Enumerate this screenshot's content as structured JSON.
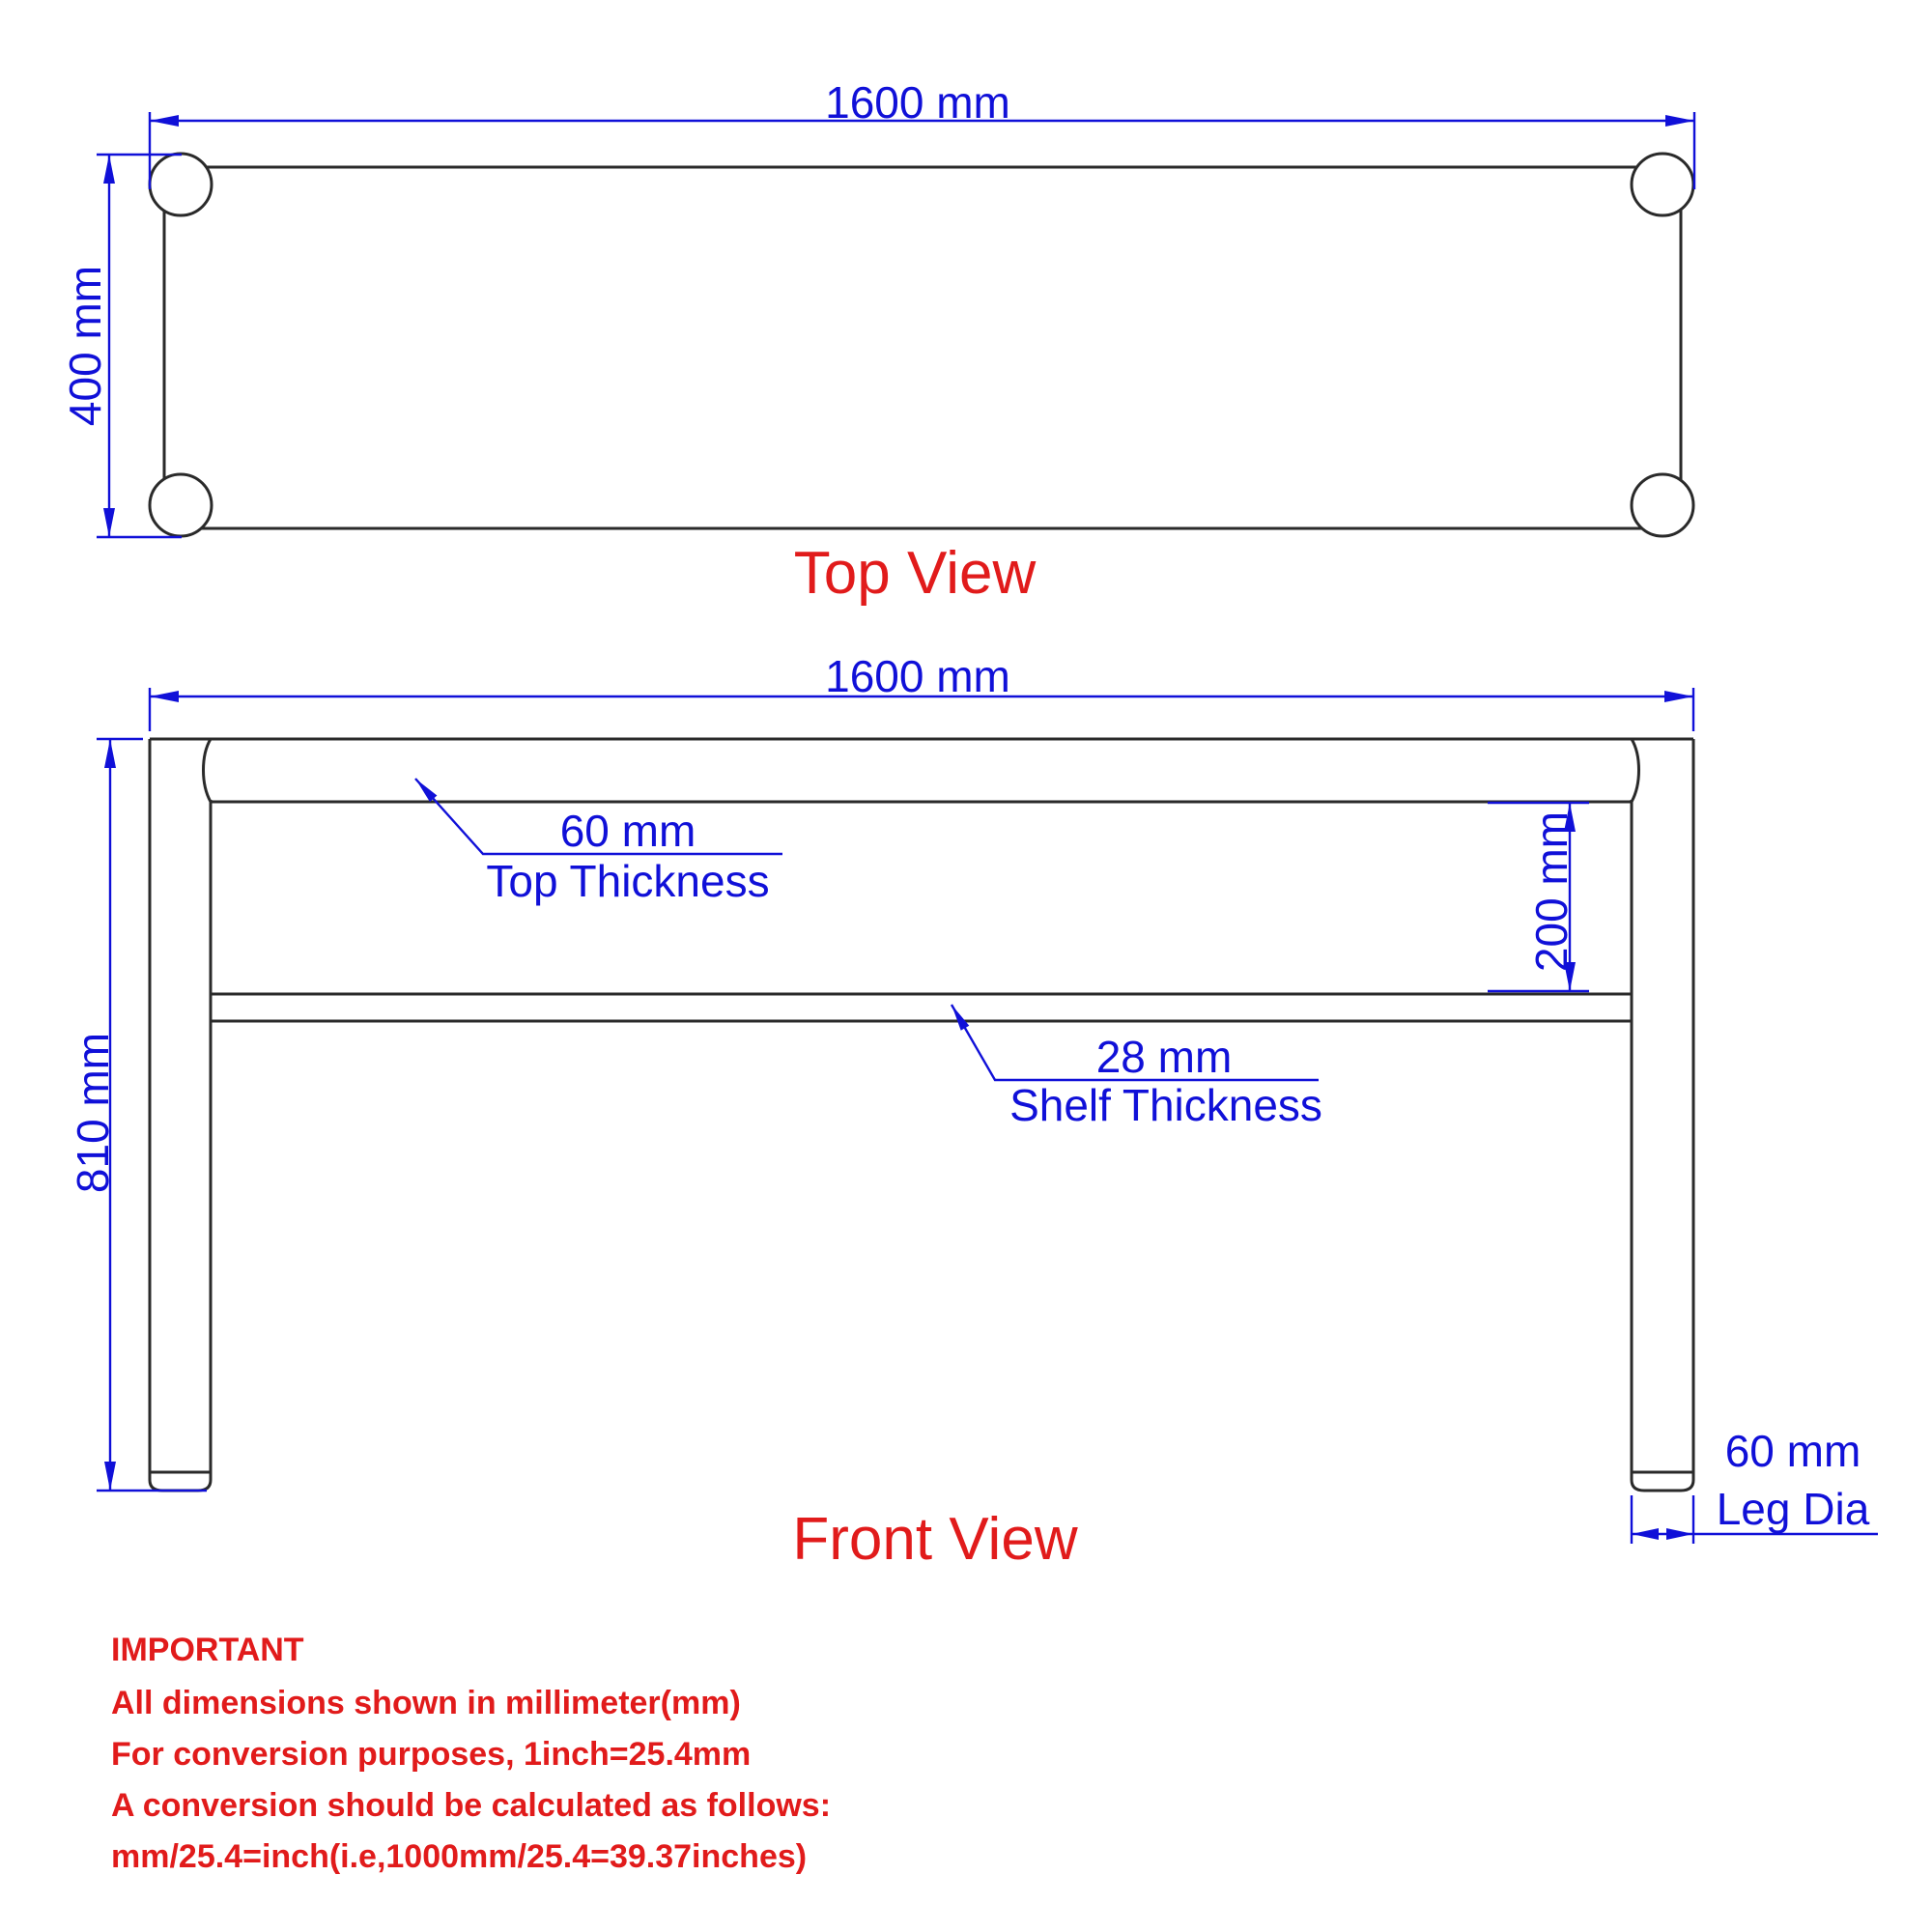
{
  "colors": {
    "dimension_blue": "#1010d8",
    "outline_black": "#2a2a2a",
    "label_red": "#e11b1b",
    "background": "#ffffff"
  },
  "top_view": {
    "title": "Top View",
    "width_dim": "1600 mm",
    "depth_dim": "400 mm"
  },
  "front_view": {
    "title": "Front View",
    "width_dim": "1600 mm",
    "height_dim": "810 mm",
    "gap_dim": "200 mm",
    "top_thickness": {
      "value": "60 mm",
      "label": "Top Thickness"
    },
    "shelf_thickness": {
      "value": "28 mm",
      "label": "Shelf Thickness"
    },
    "leg_diameter": {
      "value": "60 mm",
      "label": "Leg Dia"
    }
  },
  "notes": {
    "heading": "IMPORTANT",
    "lines": [
      "All dimensions shown in millimeter(mm)",
      "For conversion purposes, 1inch=25.4mm",
      "A conversion should be calculated as follows:",
      "mm/25.4=inch(i.e,1000mm/25.4=39.37inches)"
    ]
  }
}
